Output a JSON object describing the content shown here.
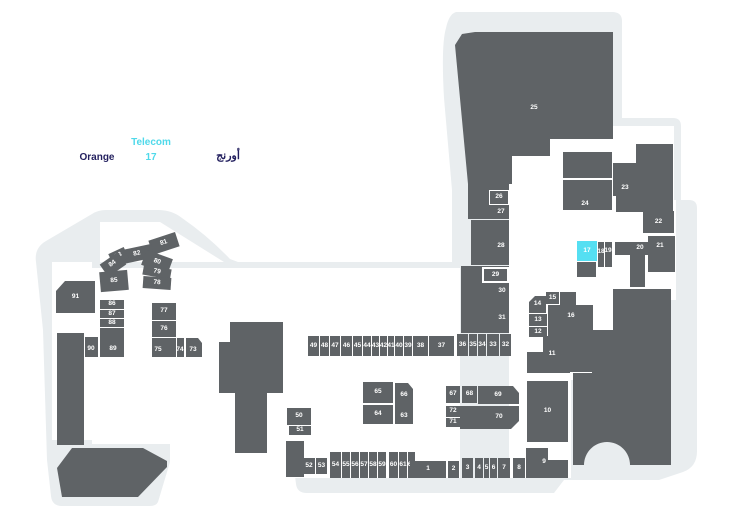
{
  "legend": {
    "store_name_en": "Orange",
    "store_type": "Telecom",
    "store_unit": "17",
    "store_name_ar": "أورنج"
  },
  "colors": {
    "floor": "#e9edef",
    "unit": "#5f6366",
    "highlight": "#55dff2",
    "navy": "#221f5e",
    "cyan": "#4fd9ea"
  },
  "map": {
    "highlighted_unit": "17",
    "structures": [
      {
        "x": 57,
        "y": 333,
        "w": 27,
        "h": 112
      },
      {
        "x": 286,
        "y": 441,
        "w": 18,
        "h": 36
      },
      {
        "x": 577,
        "y": 262,
        "w": 19,
        "h": 15
      },
      {
        "x": 630,
        "y": 255,
        "w": 15,
        "h": 32
      },
      {
        "x": 563,
        "y": 152,
        "w": 49,
        "h": 26
      },
      {
        "x": 468,
        "y": 180,
        "w": 41,
        "h": 39
      }
    ],
    "units": [
      {
        "label": "25",
        "x": 455,
        "y": 32,
        "w": 158,
        "h": 152,
        "clip": "polygon(0 13px,7px 2px,20px 0,158px 0,158px 107px,95px 107px,95px 124px,57px 124px,57px 152px,13px 152px)"
      },
      {
        "label": "26",
        "x": 489,
        "y": 190,
        "w": 20,
        "h": 15,
        "border": 1
      },
      {
        "label": "27",
        "x": 472,
        "y": 206,
        "w": 37,
        "h": 13,
        "lx": 501,
        "ly": 212
      },
      {
        "label": "28",
        "x": 471,
        "y": 220,
        "w": 38,
        "h": 45,
        "lx": 501,
        "ly": 246
      },
      {
        "label": "30",
        "x": 461,
        "y": 266,
        "w": 48,
        "h": 34,
        "lx": 502,
        "ly": 291
      },
      {
        "label": "29",
        "x": 482,
        "y": 267,
        "w": 27,
        "h": 16,
        "border": 2
      },
      {
        "label": "31",
        "x": 461,
        "y": 300,
        "w": 48,
        "h": 33,
        "lx": 502,
        "ly": 318
      },
      {
        "label": "24",
        "x": 563,
        "y": 180,
        "w": 49,
        "h": 30,
        "lx": 585,
        "ly": 204
      },
      {
        "label": "23",
        "x": 613,
        "y": 144,
        "w": 60,
        "h": 68,
        "clip": "polygon(23px 0,60px 0,60px 68px,3px 68px,3px 52px,0 52px,0 19px,23px 19px)",
        "lx": 625,
        "ly": 188
      },
      {
        "label": "22",
        "x": 643,
        "y": 211,
        "w": 31,
        "h": 22
      },
      {
        "label": "21",
        "x": 648,
        "y": 236,
        "w": 27,
        "h": 36,
        "lx": 660,
        "ly": 246
      },
      {
        "label": "20",
        "x": 615,
        "y": 242,
        "w": 33,
        "h": 13,
        "lx": 640,
        "ly": 248
      },
      {
        "label": "17",
        "x": 577,
        "y": 241,
        "w": 20,
        "h": 20,
        "hl": true
      },
      {
        "label": "18",
        "x": 598,
        "y": 242,
        "w": 6,
        "h": 25,
        "lx": 601,
        "ly": 252
      },
      {
        "label": "19",
        "x": 605,
        "y": 242,
        "w": 7,
        "h": 25,
        "lx": 608,
        "ly": 251
      },
      {
        "label": "15",
        "x": 545,
        "y": 291,
        "w": 15,
        "h": 14,
        "border": 1
      },
      {
        "label": "14",
        "x": 529,
        "y": 296,
        "w": 17,
        "h": 17,
        "clip": "polygon(6px 0,17px 0,17px 17px,0 17px,0 6px)"
      },
      {
        "label": "13",
        "x": 529,
        "y": 314,
        "w": 18,
        "h": 12
      },
      {
        "label": "12",
        "x": 529,
        "y": 327,
        "w": 18,
        "h": 10
      },
      {
        "label": "16",
        "x": 548,
        "y": 292,
        "w": 45,
        "h": 80,
        "clip": "polygon(12px 0,28px 0,28px 13px,45px 13px,45px 80px,18px 80px,18px 48px,0 48px,0 13px,12px 13px)",
        "lx": 571,
        "ly": 316
      },
      {
        "label": "11",
        "x": 527,
        "y": 336,
        "w": 43,
        "h": 37,
        "clip": "polygon(16px 0,43px 0,43px 37px,0 37px,0 16px,16px 16px)",
        "lx": 552,
        "ly": 354
      },
      {
        "label": "10",
        "x": 527,
        "y": 381,
        "w": 41,
        "h": 61
      },
      {
        "label": "9",
        "x": 526,
        "y": 440,
        "w": 42,
        "h": 38,
        "clip": "polygon(0 8px,22px 8px,22px 20px,42px 20px,42px 38px,0 38px)",
        "lx": 544,
        "ly": 462
      },
      {
        "label": "49",
        "x": 308,
        "y": 336,
        "w": 11,
        "h": 20
      },
      {
        "label": "48",
        "x": 320,
        "y": 336,
        "w": 9,
        "h": 20
      },
      {
        "label": "47",
        "x": 330,
        "y": 336,
        "w": 10,
        "h": 20
      },
      {
        "label": "46",
        "x": 341,
        "y": 336,
        "w": 11,
        "h": 20
      },
      {
        "label": "45",
        "x": 353,
        "y": 336,
        "w": 9,
        "h": 20
      },
      {
        "label": "44",
        "x": 363,
        "y": 336,
        "w": 8,
        "h": 20
      },
      {
        "label": "43",
        "x": 372,
        "y": 336,
        "w": 7,
        "h": 20
      },
      {
        "label": "42",
        "x": 380,
        "y": 336,
        "w": 7,
        "h": 20
      },
      {
        "label": "41",
        "x": 388,
        "y": 336,
        "w": 6,
        "h": 20
      },
      {
        "label": "40",
        "x": 395,
        "y": 336,
        "w": 8,
        "h": 20
      },
      {
        "label": "39",
        "x": 404,
        "y": 336,
        "w": 8,
        "h": 20
      },
      {
        "label": "38",
        "x": 413,
        "y": 336,
        "w": 15,
        "h": 20
      },
      {
        "label": "37",
        "x": 429,
        "y": 336,
        "w": 25,
        "h": 20
      },
      {
        "label": "36",
        "x": 457,
        "y": 334,
        "w": 11,
        "h": 22
      },
      {
        "label": "35",
        "x": 469,
        "y": 334,
        "w": 8,
        "h": 22
      },
      {
        "label": "34",
        "x": 478,
        "y": 334,
        "w": 8,
        "h": 22
      },
      {
        "label": "33",
        "x": 487,
        "y": 334,
        "w": 12,
        "h": 22
      },
      {
        "label": "32",
        "x": 500,
        "y": 334,
        "w": 11,
        "h": 22
      },
      {
        "label": "91",
        "x": 56,
        "y": 281,
        "w": 39,
        "h": 32,
        "clip": "polygon(0 10px,9px 0,39px 0,39px 32px,0 32px)"
      },
      {
        "label": "86",
        "x": 100,
        "y": 300,
        "w": 24,
        "h": 9
      },
      {
        "label": "87",
        "x": 100,
        "y": 310,
        "w": 24,
        "h": 8
      },
      {
        "label": "88",
        "x": 100,
        "y": 319,
        "w": 24,
        "h": 8
      },
      {
        "label": "89",
        "x": 100,
        "y": 328,
        "w": 24,
        "h": 29,
        "lx": 113,
        "ly": 349
      },
      {
        "label": "90",
        "x": 85,
        "y": 337,
        "w": 13,
        "h": 20,
        "lx": 91,
        "ly": 349
      },
      {
        "label": "77",
        "x": 152,
        "y": 303,
        "w": 24,
        "h": 17
      },
      {
        "label": "76",
        "x": 152,
        "y": 321,
        "w": 24,
        "h": 16
      },
      {
        "label": "75",
        "x": 152,
        "y": 338,
        "w": 24,
        "h": 19,
        "lx": 158,
        "ly": 350
      },
      {
        "label": "74",
        "x": 177,
        "y": 338,
        "w": 7,
        "h": 19,
        "lx": 180,
        "ly": 350
      },
      {
        "label": "73",
        "x": 186,
        "y": 338,
        "w": 16,
        "h": 19,
        "clip": "polygon(0 0,12px 0,16px 5px,16px 19px,0 19px)",
        "lx": 193,
        "ly": 350
      },
      {
        "label": "81",
        "x": 150,
        "y": 236,
        "w": 28,
        "h": 15,
        "rot": -18
      },
      {
        "label": "82",
        "x": 121,
        "y": 247,
        "w": 32,
        "h": 14,
        "rot": -12
      },
      {
        "label": "83",
        "x": 110,
        "y": 250,
        "w": 17,
        "h": 12,
        "rot": -25
      },
      {
        "label": "84",
        "x": 102,
        "y": 257,
        "w": 22,
        "h": 15,
        "rot": -35
      },
      {
        "label": "85",
        "x": 100,
        "y": 271,
        "w": 28,
        "h": 20,
        "rot": -5
      },
      {
        "label": "80",
        "x": 143,
        "y": 254,
        "w": 28,
        "h": 16,
        "rot": 20
      },
      {
        "label": "79",
        "x": 143,
        "y": 267,
        "w": 28,
        "h": 10,
        "rot": 10
      },
      {
        "label": "78",
        "x": 143,
        "y": 277,
        "w": 28,
        "h": 12,
        "rot": 4
      },
      {
        "label": "50",
        "x": 287,
        "y": 408,
        "w": 24,
        "h": 17
      },
      {
        "label": "51",
        "x": 289,
        "y": 426,
        "w": 22,
        "h": 9
      },
      {
        "label": "65",
        "x": 363,
        "y": 382,
        "w": 30,
        "h": 21
      },
      {
        "label": "64",
        "x": 363,
        "y": 405,
        "w": 30,
        "h": 19
      },
      {
        "label": "66",
        "x": 395,
        "y": 383,
        "w": 18,
        "h": 25,
        "clip": "polygon(0 0,13px 0,18px 6px,18px 25px,0 25px)"
      },
      {
        "label": "63",
        "x": 395,
        "y": 408,
        "w": 18,
        "h": 16
      },
      {
        "label": "67",
        "x": 446,
        "y": 386,
        "w": 14,
        "h": 17
      },
      {
        "label": "68",
        "x": 462,
        "y": 386,
        "w": 15,
        "h": 17
      },
      {
        "label": "69",
        "x": 478,
        "y": 386,
        "w": 41,
        "h": 18,
        "clip": "polygon(0 0,35px 0,41px 7px,41px 18px,0 18px)",
        "lx": 498,
        "ly": 395
      },
      {
        "label": "72",
        "x": 446,
        "y": 406,
        "w": 14,
        "h": 11
      },
      {
        "label": "71",
        "x": 446,
        "y": 418,
        "w": 14,
        "h": 9
      },
      {
        "label": "70",
        "x": 460,
        "y": 406,
        "w": 59,
        "h": 23,
        "clip": "polygon(0 0,59px 0,59px 15px,51px 23px,0 23px)",
        "lx": 499,
        "ly": 417
      },
      {
        "label": "52",
        "x": 303,
        "y": 458,
        "w": 12,
        "h": 16
      },
      {
        "label": "53",
        "x": 316,
        "y": 458,
        "w": 11,
        "h": 16
      },
      {
        "label": "54",
        "x": 330,
        "y": 452,
        "w": 11,
        "h": 26
      },
      {
        "label": "55",
        "x": 342,
        "y": 452,
        "w": 8,
        "h": 26
      },
      {
        "label": "56",
        "x": 351,
        "y": 452,
        "w": 8,
        "h": 26
      },
      {
        "label": "57",
        "x": 360,
        "y": 452,
        "w": 8,
        "h": 26
      },
      {
        "label": "58",
        "x": 369,
        "y": 452,
        "w": 8,
        "h": 26
      },
      {
        "label": "59",
        "x": 378,
        "y": 452,
        "w": 8,
        "h": 26
      },
      {
        "label": "60",
        "x": 389,
        "y": 452,
        "w": 9,
        "h": 26
      },
      {
        "label": "61",
        "x": 399,
        "y": 452,
        "w": 8,
        "h": 26
      },
      {
        "label": "62",
        "x": 408,
        "y": 452,
        "w": 7,
        "h": 26
      },
      {
        "label": "1",
        "x": 410,
        "y": 461,
        "w": 36,
        "h": 17
      },
      {
        "label": "2",
        "x": 448,
        "y": 461,
        "w": 11,
        "h": 17
      },
      {
        "label": "3",
        "x": 462,
        "y": 458,
        "w": 11,
        "h": 20
      },
      {
        "label": "4",
        "x": 475,
        "y": 458,
        "w": 8,
        "h": 20
      },
      {
        "label": "5",
        "x": 484,
        "y": 458,
        "w": 5,
        "h": 20
      },
      {
        "label": "6",
        "x": 490,
        "y": 458,
        "w": 7,
        "h": 20
      },
      {
        "label": "7",
        "x": 498,
        "y": 458,
        "w": 12,
        "h": 20
      },
      {
        "label": "8",
        "x": 513,
        "y": 458,
        "w": 12,
        "h": 20
      }
    ]
  }
}
